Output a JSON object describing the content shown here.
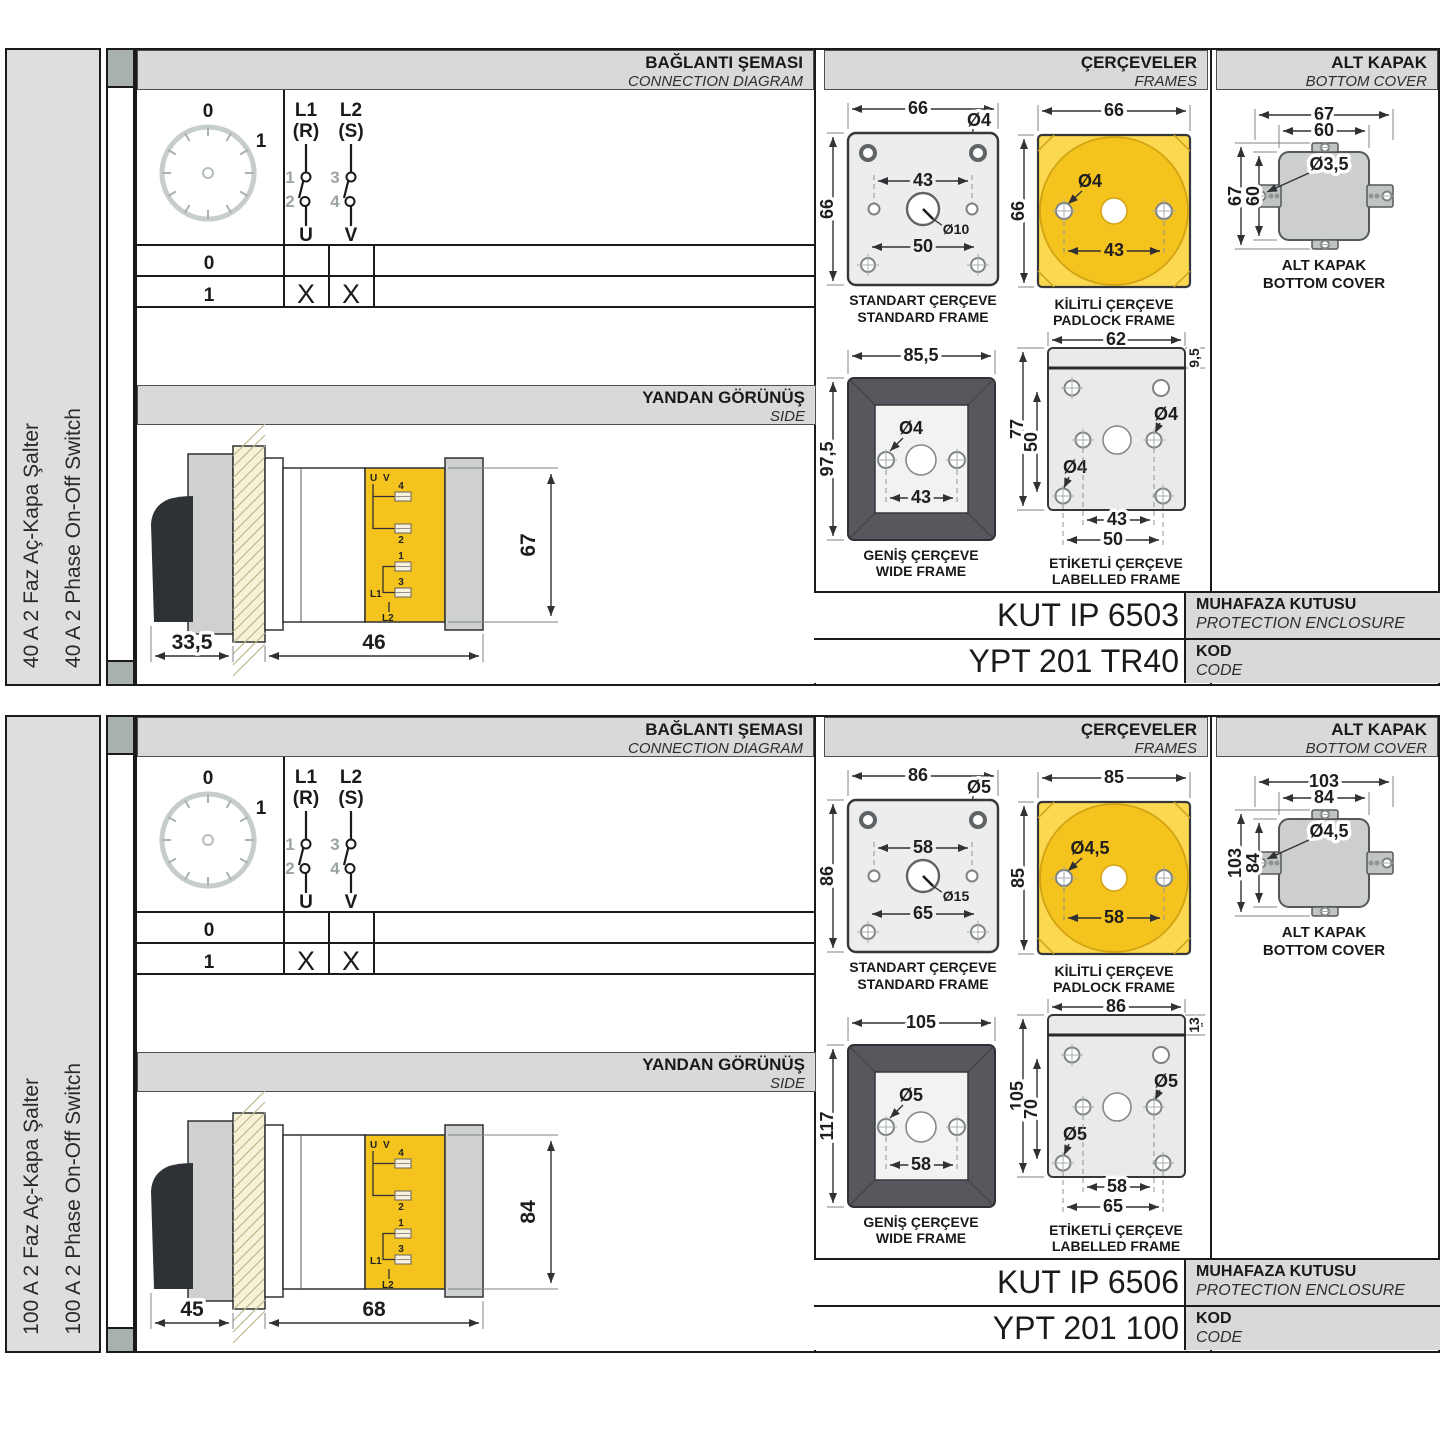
{
  "colors": {
    "accent_yellow": "#F5C31D",
    "panel_grey": "#D9D9D9",
    "wide_frame_grey": "#57585E"
  },
  "sections": [
    {
      "product_tr": "40 A 2 Faz Aç-Kapa Şalter",
      "product_en": "40 A 2 Phase On-Off Switch",
      "headers": {
        "diagram_tr": "BAĞLANTI ŞEMASI",
        "diagram_en": "CONNECTION DIAGRAM",
        "frames_tr": "ÇERÇEVELER",
        "frames_en": "FRAMES",
        "cover_tr": "ALT KAPAK",
        "cover_en": "BOTTOM COVER",
        "side_tr": "YANDAN GÖRÜNÜŞ",
        "side_en": "SIDE"
      },
      "connection": {
        "pos0": "0",
        "pos1": "1",
        "p1_line": "L1",
        "p1_phase": "(R)",
        "p2_line": "L2",
        "p2_phase": "(S)",
        "c1": "1",
        "c2": "2",
        "c3": "3",
        "c4": "4",
        "out1": "U",
        "out2": "V",
        "row0": "0",
        "row1": "1",
        "x1": "X",
        "x2": "X"
      },
      "side_view": {
        "front_depth": "33,5",
        "rear_depth": "46",
        "height": "67",
        "t_u": "U",
        "t_v": "V",
        "t4": "4",
        "t2": "2",
        "t1": "1",
        "t3": "3",
        "l1": "L1",
        "l2": "L2"
      },
      "frames": {
        "standard": {
          "width": "66",
          "height": "66",
          "hole": "Ø4",
          "spacing": "43",
          "shaft": "Ø10",
          "lower_spacing": "50",
          "cap_tr": "STANDART ÇERÇEVE",
          "cap_en": "STANDARD FRAME"
        },
        "padlock": {
          "width": "66",
          "height": "66",
          "hole": "Ø4",
          "spacing": "43",
          "cap_tr": "KİLİTLİ ÇERÇEVE",
          "cap_en": "PADLOCK FRAME"
        },
        "wide": {
          "width": "85,5",
          "height": "97,5",
          "hole": "Ø4",
          "spacing": "43",
          "cap_tr": "GENİŞ ÇERÇEVE",
          "cap_en": "WIDE FRAME"
        },
        "labelled": {
          "width": "62",
          "strip": "9,5",
          "height": "77",
          "inner_height": "50",
          "hole_top": "Ø4",
          "hole_bottom": "Ø4",
          "spacing": "43",
          "lower_spacing": "50",
          "cap_tr": "ETİKETLİ ÇERÇEVE",
          "cap_en": "LABELLED FRAME"
        }
      },
      "cover": {
        "outer_w": "67",
        "inner_w": "60",
        "outer_h": "67",
        "inner_h": "60",
        "hole": "Ø3,5",
        "cap_tr": "ALT KAPAK",
        "cap_en": "BOTTOM COVER"
      },
      "codes": {
        "enclosure_value": "KUT IP 6503",
        "enclosure_tr": "MUHAFAZA KUTUSU",
        "enclosure_en": "PROTECTION ENCLOSURE",
        "code_value": "YPT 201 TR40",
        "code_tr": "KOD",
        "code_en": "CODE"
      }
    },
    {
      "product_tr": "100 A 2 Faz Aç-Kapa Şalter",
      "product_en": "100 A 2 Phase On-Off Switch",
      "headers": {
        "diagram_tr": "BAĞLANTI ŞEMASI",
        "diagram_en": "CONNECTION DIAGRAM",
        "frames_tr": "ÇERÇEVELER",
        "frames_en": "FRAMES",
        "cover_tr": "ALT KAPAK",
        "cover_en": "BOTTOM COVER",
        "side_tr": "YANDAN GÖRÜNÜŞ",
        "side_en": "SIDE"
      },
      "connection": {
        "pos0": "0",
        "pos1": "1",
        "p1_line": "L1",
        "p1_phase": "(R)",
        "p2_line": "L2",
        "p2_phase": "(S)",
        "c1": "1",
        "c2": "2",
        "c3": "3",
        "c4": "4",
        "out1": "U",
        "out2": "V",
        "row0": "0",
        "row1": "1",
        "x1": "X",
        "x2": "X"
      },
      "side_view": {
        "front_depth": "45",
        "rear_depth": "68",
        "height": "84",
        "t_u": "U",
        "t_v": "V",
        "t4": "4",
        "t2": "2",
        "t1": "1",
        "t3": "3",
        "l1": "L1",
        "l2": "L2"
      },
      "frames": {
        "standard": {
          "width": "86",
          "height": "86",
          "hole": "Ø5",
          "spacing": "58",
          "shaft": "Ø15",
          "lower_spacing": "65",
          "cap_tr": "STANDART ÇERÇEVE",
          "cap_en": "STANDARD FRAME"
        },
        "padlock": {
          "width": "85",
          "height": "85",
          "hole": "Ø4,5",
          "spacing": "58",
          "cap_tr": "KİLİTLİ ÇERÇEVE",
          "cap_en": "PADLOCK FRAME"
        },
        "wide": {
          "width": "105",
          "height": "117",
          "hole": "Ø5",
          "spacing": "58",
          "cap_tr": "GENİŞ ÇERÇEVE",
          "cap_en": "WIDE FRAME"
        },
        "labelled": {
          "width": "86",
          "strip": "13",
          "height": "105",
          "inner_height": "70",
          "hole_top": "Ø5",
          "hole_bottom": "Ø5",
          "spacing": "58",
          "lower_spacing": "65",
          "cap_tr": "ETİKETLİ ÇERÇEVE",
          "cap_en": "LABELLED FRAME"
        }
      },
      "cover": {
        "outer_w": "103",
        "inner_w": "84",
        "outer_h": "103",
        "inner_h": "84",
        "hole": "Ø4,5",
        "cap_tr": "ALT KAPAK",
        "cap_en": "BOTTOM COVER"
      },
      "codes": {
        "enclosure_value": "KUT IP 6506",
        "enclosure_tr": "MUHAFAZA KUTUSU",
        "enclosure_en": "PROTECTION ENCLOSURE",
        "code_value": "YPT 201 100",
        "code_tr": "KOD",
        "code_en": "CODE"
      }
    }
  ]
}
